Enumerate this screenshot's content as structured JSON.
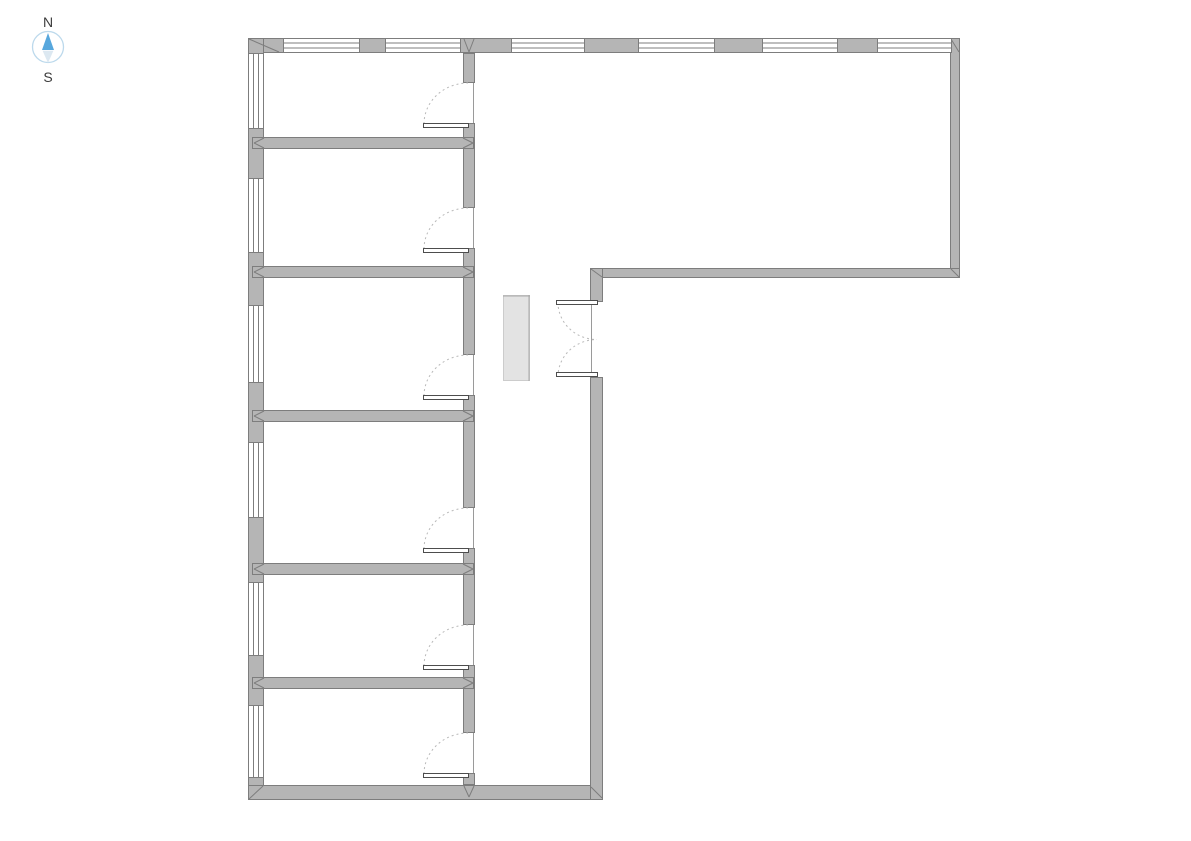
{
  "compass": {
    "north_label": "N",
    "south_label": "S"
  },
  "colors": {
    "background": "#ffffff",
    "wall_fill": "#b5b5b5",
    "wall_stroke": "#7d7d7d",
    "window_fill": "#ffffff",
    "window_line": "#7d7d7d",
    "door_leaf_fill": "#ffffff",
    "door_leaf_stroke": "#4d4d4d",
    "door_arc": "#b9b9b9",
    "opening_edge": "#9a9a9a",
    "fixture_fill": "#e3e3e3",
    "fixture_edge": "#a8a8a8",
    "fixture_border": "#cccccc",
    "compass_blue": "#57a7dd",
    "compass_pale": "#dce8f1",
    "compass_ring": "#bcd9ec",
    "compass_text": "#3c3c3c"
  },
  "plan": {
    "canvas": {
      "w": 1191,
      "h": 841
    },
    "walls": [
      {
        "name": "top-exterior-wall",
        "x": 248,
        "y": 38,
        "w": 712,
        "h": 15
      },
      {
        "name": "left-exterior-wall",
        "x": 248,
        "y": 38,
        "w": 16,
        "h": 762
      },
      {
        "name": "bottom-exterior-wall",
        "x": 248,
        "y": 785,
        "w": 355,
        "h": 15
      },
      {
        "name": "right-exterior-wall",
        "x": 950,
        "y": 38,
        "w": 10,
        "h": 240
      },
      {
        "name": "east-wing-south-wall",
        "x": 592,
        "y": 268,
        "w": 368,
        "h": 10
      },
      {
        "name": "corridor-east-wall-upper",
        "x": 590,
        "y": 268,
        "w": 13,
        "h": 34
      },
      {
        "name": "corridor-east-wall-lower",
        "x": 590,
        "y": 377,
        "w": 13,
        "h": 423
      },
      {
        "name": "rooms-east-wall-seg-1",
        "x": 463,
        "y": 53,
        "w": 12,
        "h": 30
      },
      {
        "name": "rooms-east-wall-seg-2",
        "x": 463,
        "y": 123,
        "w": 12,
        "h": 85
      },
      {
        "name": "rooms-east-wall-seg-3",
        "x": 463,
        "y": 248,
        "w": 12,
        "h": 107
      },
      {
        "name": "rooms-east-wall-seg-4",
        "x": 463,
        "y": 395,
        "w": 12,
        "h": 113
      },
      {
        "name": "rooms-east-wall-seg-5",
        "x": 463,
        "y": 548,
        "w": 12,
        "h": 77
      },
      {
        "name": "rooms-east-wall-seg-6",
        "x": 463,
        "y": 665,
        "w": 12,
        "h": 68
      },
      {
        "name": "rooms-east-wall-seg-7",
        "x": 463,
        "y": 773,
        "w": 12,
        "h": 12
      },
      {
        "name": "partition-wall-1",
        "x": 252,
        "y": 137,
        "w": 222,
        "h": 12
      },
      {
        "name": "partition-wall-2",
        "x": 252,
        "y": 266,
        "w": 222,
        "h": 12
      },
      {
        "name": "partition-wall-3",
        "x": 252,
        "y": 410,
        "w": 222,
        "h": 12
      },
      {
        "name": "partition-wall-4",
        "x": 252,
        "y": 563,
        "w": 222,
        "h": 12
      },
      {
        "name": "partition-wall-5",
        "x": 252,
        "y": 677,
        "w": 222,
        "h": 12
      }
    ],
    "top_windows": {
      "y": 38,
      "h": 15,
      "spans": [
        {
          "x": 283,
          "w": 77
        },
        {
          "x": 385,
          "w": 76
        },
        {
          "x": 511,
          "w": 74
        },
        {
          "x": 638,
          "w": 77
        },
        {
          "x": 762,
          "w": 76
        },
        {
          "x": 877,
          "w": 75
        }
      ]
    },
    "left_windows": {
      "x": 248,
      "w": 16,
      "spans": [
        {
          "y": 53,
          "h": 76
        },
        {
          "y": 178,
          "h": 75
        },
        {
          "y": 305,
          "h": 78
        },
        {
          "y": 442,
          "h": 76
        },
        {
          "y": 582,
          "h": 74
        },
        {
          "y": 705,
          "h": 73
        }
      ]
    },
    "room_doors": {
      "wall_x": 463,
      "wall_w": 12,
      "opening_h": 40,
      "leaf_x": 423,
      "leaf_w": 46,
      "leaf_h": 5,
      "openings_y": [
        83,
        208,
        355,
        508,
        625,
        733
      ]
    },
    "double_door": {
      "wall_x": 590,
      "wall_w": 13,
      "y_top": 302,
      "y_bottom": 377,
      "leaf_x": 556,
      "leaf_w": 42,
      "leaf_h": 5
    },
    "fixture": {
      "x": 503,
      "y": 295,
      "w": 27,
      "h": 86
    },
    "corner_miters": [
      [
        249,
        39,
        279,
        52
      ],
      [
        951,
        39,
        959,
        52
      ],
      [
        249,
        799,
        263,
        786
      ],
      [
        591,
        787,
        602,
        798
      ],
      [
        951,
        269,
        959,
        277
      ],
      [
        591,
        269,
        602,
        277
      ],
      [
        464,
        39,
        469,
        52
      ],
      [
        474,
        39,
        469,
        52
      ],
      [
        464,
        786,
        469,
        797
      ],
      [
        474,
        786,
        469,
        797
      ]
    ]
  }
}
